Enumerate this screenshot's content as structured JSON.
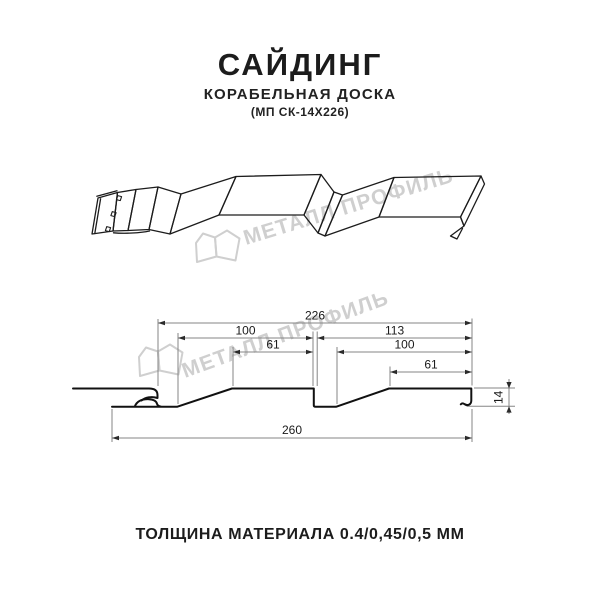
{
  "header": {
    "title": "САЙДИНГ",
    "subtitle": "КОРАБЕЛЬНАЯ ДОСКА",
    "model": "(МП СК-14Х226)"
  },
  "watermark": {
    "brand": "МЕТАЛЛ ПРОФИЛЬ",
    "color": "#cfcfcf"
  },
  "dims": {
    "total": "226",
    "left_module": "100",
    "right_module": "113",
    "left_flat": "61",
    "right_inner": "100",
    "right_flat": "61",
    "overall": "260",
    "depth": "14"
  },
  "footer": {
    "thickness_note": "ТОЛЩИНА МАТЕРИАЛА 0.4/0,45/0,5 ММ"
  },
  "colors": {
    "ink": "#1c1c1c",
    "profile_line": "#111111",
    "dimension_line": "#858585",
    "watermark": "#cfcfcf"
  }
}
